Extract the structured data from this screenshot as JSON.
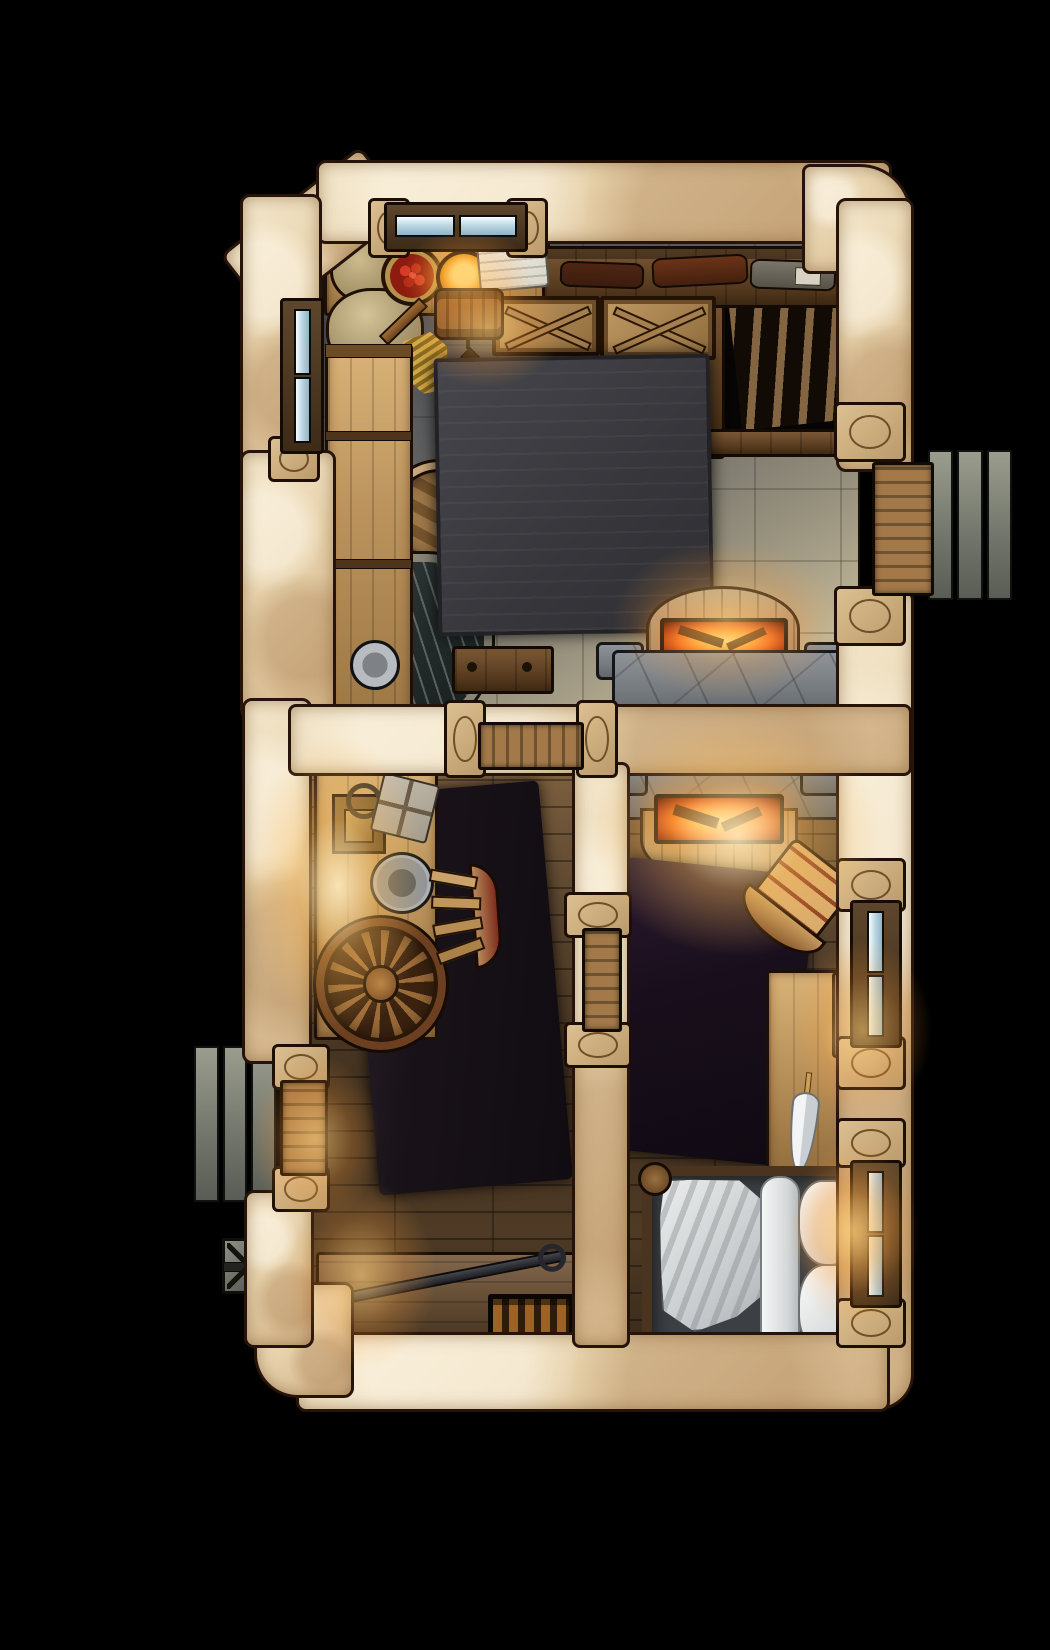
{
  "map": {
    "kind": "top-down RPG battle map",
    "subject": "stone-and-timber cottage interior at night",
    "background_color": "#000000",
    "no_visible_text": true
  },
  "palette": {
    "exterior_wall": "#e7d2ac",
    "wall_outline": "#26140a",
    "stone_floor_shadow": "#55575c",
    "stone_floor_lit": "#d6caa8",
    "wood_floor": "#4e3a25",
    "ember_glow": "#ff7a1e",
    "window_glass": "#bed8e4",
    "dark_rug": "#191319",
    "purple_rug": "#190f1c",
    "linen_white": "#eef0f2",
    "step_stone": "#70746a"
  },
  "rooms": [
    {
      "name": "great room and kitchen",
      "floor": "stone flagstone, dark in shadow fading to warm light near the hearth",
      "contents": [
        "kitchen counter",
        "two burlap sacks",
        "basket of red tomatoes",
        "glowing yellow porridge bowl",
        "white kitchen cloth",
        "hanging barrel lamp with candle",
        "broom",
        "wine shelf with three bottles",
        "two x-braced crates",
        "dark storage niche with slatted rack",
        "large dark table",
        "bar counter",
        "round barrel",
        "stone washing tub with water",
        "metal plate",
        "small wall shelf",
        "upper hearth of double fireplace"
      ]
    },
    {
      "name": "workroom",
      "floor": "wood planks",
      "contents": [
        "long side table",
        "candle plate with ring handle",
        "wrapped parcel tied with string",
        "metal bowl",
        "large wagon wheel",
        "wooden chair",
        "dark floor rug",
        "workbench",
        "iron poker",
        "slatted cage crate"
      ]
    },
    {
      "name": "bedroom",
      "floor": "wood planks lit by hearth",
      "contents": [
        "lower hearth of double fireplace",
        "dark purple rug",
        "tilted wooden chair",
        "writing desk with white quill feather",
        "candle stand with three candles",
        "stack of books",
        "double bed with grey mattress, crumpled white blanket, bolster and two pillows"
      ]
    }
  ],
  "features": {
    "windows": [
      "double window in top wall",
      "tall window in left wall",
      "two tall windows in right wall"
    ],
    "doors": [
      "exterior plank door in right wall with three stone steps outside",
      "exterior plank door in left wall with three stone steps outside",
      "interior plank door between great room and workroom",
      "interior plank door between workroom and bedroom"
    ],
    "fireplace": "double-sided stone fireplace with two glowing ember fireboxes shared between great room and bedroom",
    "exterior_lamp": "cross-braced metal lamp outside the lower-left wall"
  },
  "lighting": [
    "warm candle glow over kitchen counter",
    "sconce glow on left workroom wall",
    "strong ember glow on both sides of the fireplace",
    "candle glow beside the writing desk",
    "warm glow at both exterior doors and right bedroom window"
  ]
}
